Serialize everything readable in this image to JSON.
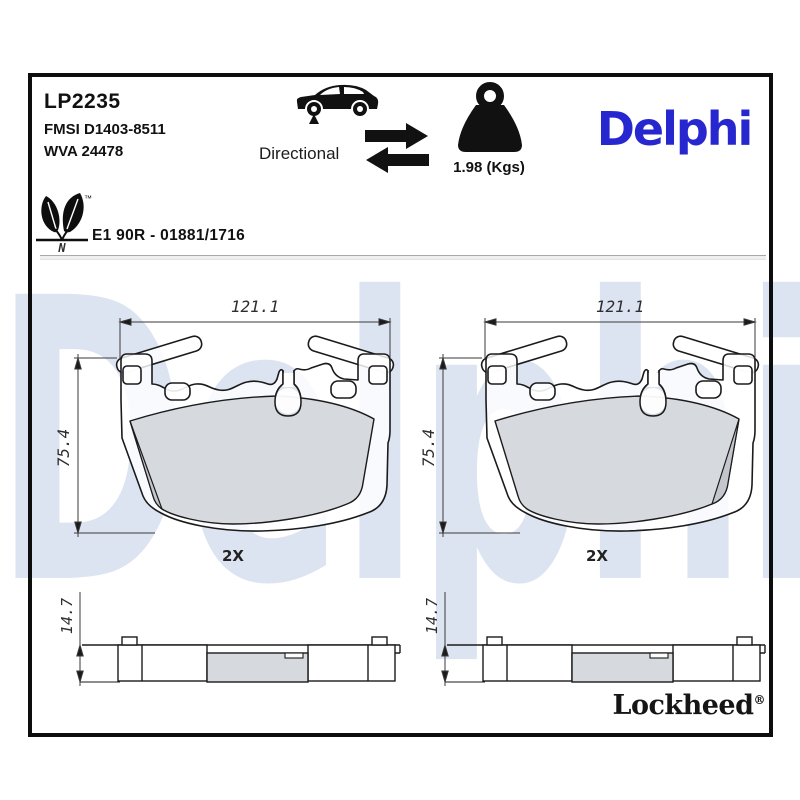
{
  "header": {
    "part_number": "LP2235",
    "fmsi_code": "FMSI D1403-8511",
    "wva_code": "WVA 24478"
  },
  "directional": {
    "label": "Directional"
  },
  "weight": {
    "value": "1.98 (Kgs)"
  },
  "brand": {
    "name": "Delphi"
  },
  "homologation": {
    "approval_text": "E1 90R - 01881/1716",
    "leaf_mark_letter": "N",
    "trademark": "™"
  },
  "watermark": {
    "text": "Delphi",
    "color": "#dde4f1"
  },
  "drawings": {
    "front_left": {
      "width_mm": "121.1",
      "height_mm": "75.4",
      "quantity": "2X"
    },
    "front_right": {
      "width_mm": "121.1",
      "height_mm": "75.4",
      "quantity": "2X"
    },
    "side_left": {
      "thickness_mm": "14.7"
    },
    "side_right": {
      "thickness_mm": "14.7"
    }
  },
  "footer": {
    "brand": "Lockheed",
    "registered_mark": "®"
  },
  "colors": {
    "delphi_blue": "#2727cf",
    "friction_gray": "#d2d6db",
    "chamfer_gray": "#c3c7cd",
    "line_black": "#1b1b1b"
  }
}
